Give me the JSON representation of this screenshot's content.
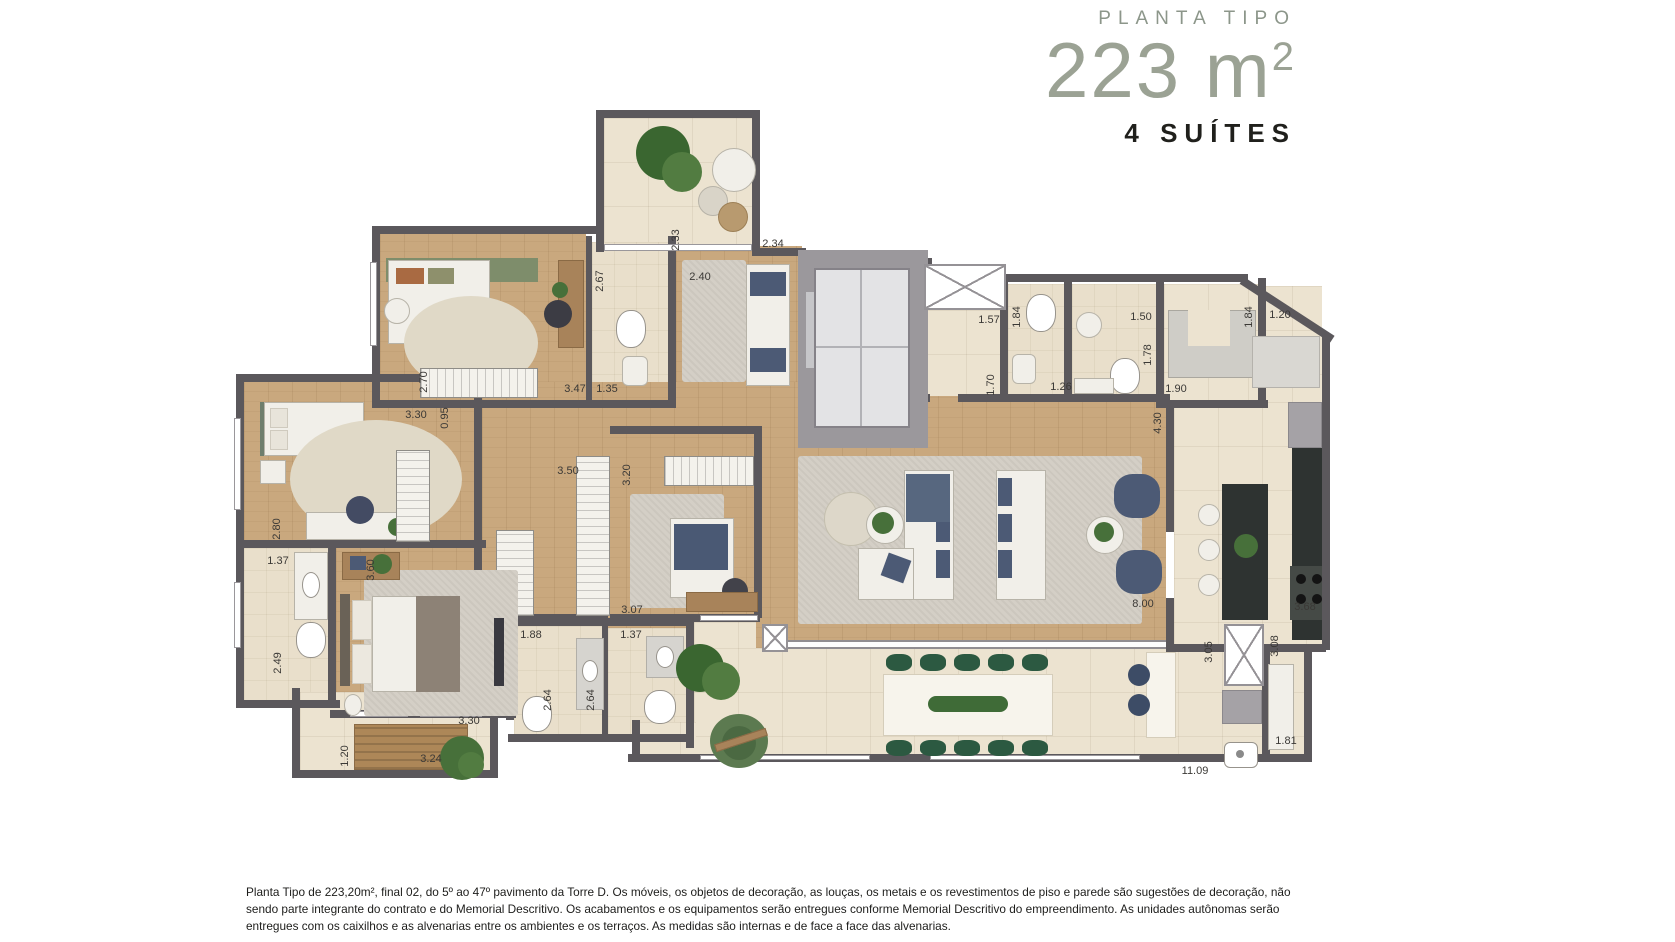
{
  "header": {
    "eyebrow": "PLANTA TIPO",
    "area": "223 m",
    "area_sup": "2",
    "suites": "4 SUÍTES"
  },
  "footer": {
    "text": "Planta Tipo de 223,20m², final 02, do 5º ao 47º pavimento da Torre D. Os móveis, os objetos de decoração, as louças, os metais e os revestimentos de piso e parede são sugestões de decoração, não sendo parte integrante do contrato e do Memorial Descritivo. Os acabamentos e os equipamentos serão entregues conforme Memorial Descritivo do empreendimento. As unidades autônomas serão entregues com os caixilhos e as alvenarias entre os ambientes e os terraços. As medidas são internas e de face a face das alvenarias."
  },
  "colors": {
    "title_green": "#8c968a",
    "number_green": "#9ba294",
    "dark_text": "#20201c",
    "wall": "#5b585c",
    "wood_floor": "#c9a87e",
    "tile_floor": "#ece3d0"
  },
  "dimensions": [
    {
      "v": "2.33",
      "x": 676,
      "y": 240,
      "r": 1
    },
    {
      "v": "2.34",
      "x": 773,
      "y": 244
    },
    {
      "v": "2.67",
      "x": 600,
      "y": 281,
      "r": 1
    },
    {
      "v": "2.40",
      "x": 700,
      "y": 277
    },
    {
      "v": "2.70",
      "x": 424,
      "y": 382,
      "r": 1
    },
    {
      "v": "3.47",
      "x": 575,
      "y": 389
    },
    {
      "v": "1.35",
      "x": 607,
      "y": 389
    },
    {
      "v": "1.57",
      "x": 989,
      "y": 320
    },
    {
      "v": "1.70",
      "x": 991,
      "y": 385,
      "r": 1
    },
    {
      "v": "1.84",
      "x": 1017,
      "y": 317,
      "r": 1
    },
    {
      "v": "1.26",
      "x": 1061,
      "y": 387
    },
    {
      "v": "1.50",
      "x": 1141,
      "y": 317
    },
    {
      "v": "1.78",
      "x": 1148,
      "y": 355,
      "r": 1
    },
    {
      "v": "1.84",
      "x": 1249,
      "y": 317,
      "r": 1
    },
    {
      "v": "1.20",
      "x": 1280,
      "y": 315
    },
    {
      "v": "1.90",
      "x": 1176,
      "y": 389
    },
    {
      "v": "4.30",
      "x": 1158,
      "y": 423,
      "r": 1
    },
    {
      "v": "3.30",
      "x": 416,
      "y": 415
    },
    {
      "v": "0.95",
      "x": 445,
      "y": 418,
      "r": 1
    },
    {
      "v": "3.50",
      "x": 568,
      "y": 471
    },
    {
      "v": "3.20",
      "x": 627,
      "y": 475,
      "r": 1
    },
    {
      "v": "2.80",
      "x": 277,
      "y": 529,
      "r": 1
    },
    {
      "v": "1.37",
      "x": 278,
      "y": 561
    },
    {
      "v": "3.60",
      "x": 371,
      "y": 570,
      "r": 1
    },
    {
      "v": "2.49",
      "x": 278,
      "y": 663,
      "r": 1
    },
    {
      "v": "1.88",
      "x": 531,
      "y": 635
    },
    {
      "v": "1.37",
      "x": 631,
      "y": 635
    },
    {
      "v": "3.07",
      "x": 632,
      "y": 610
    },
    {
      "v": "8.00",
      "x": 1143,
      "y": 604
    },
    {
      "v": "3.68",
      "x": 1305,
      "y": 607
    },
    {
      "v": "3.05",
      "x": 1209,
      "y": 652,
      "r": 1
    },
    {
      "v": "3.08",
      "x": 1275,
      "y": 646,
      "r": 1
    },
    {
      "v": "2.64",
      "x": 548,
      "y": 700,
      "r": 1
    },
    {
      "v": "2.64",
      "x": 591,
      "y": 700,
      "r": 1
    },
    {
      "v": "3.30",
      "x": 469,
      "y": 721
    },
    {
      "v": "1.81",
      "x": 1286,
      "y": 741
    },
    {
      "v": "11.09",
      "x": 1195,
      "y": 771
    },
    {
      "v": "1.20",
      "x": 345,
      "y": 756,
      "r": 1
    },
    {
      "v": "3.24",
      "x": 431,
      "y": 759
    }
  ]
}
